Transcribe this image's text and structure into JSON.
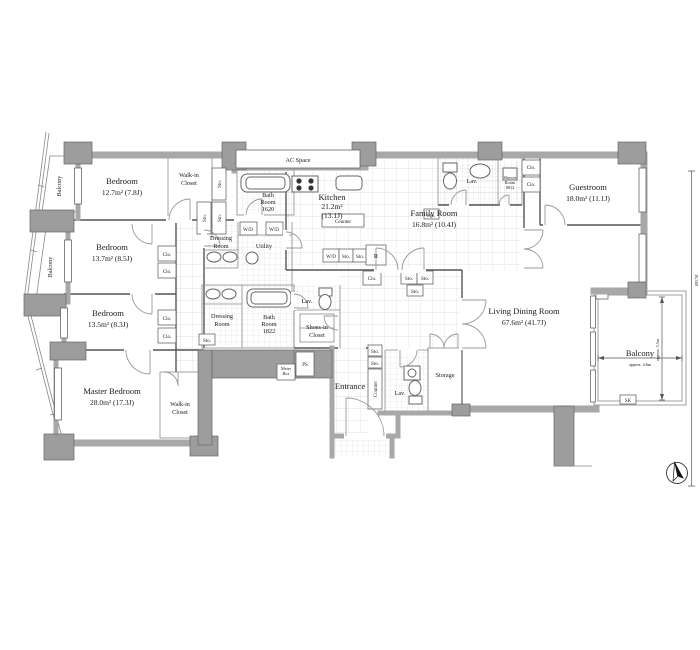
{
  "title": {
    "code": "H602",
    "suffix": "type",
    "spec": "4BR/296.90m²(89.81tsubo)"
  },
  "rooms": {
    "bedroom1": {
      "name": "Bedroom",
      "area": "12.7m²  (7.8J)"
    },
    "bedroom2": {
      "name": "Bedroom",
      "area": "13.7m²  (8.5J)"
    },
    "bedroom3": {
      "name": "Bedroom",
      "area": "13.5m²  (8.3J)"
    },
    "master": {
      "name": "Master Bedroom",
      "area": "28.0m²  (17.3J)"
    },
    "guestroom": {
      "name": "Guestroom",
      "area": "18.0m²  (11.1J)"
    },
    "kitchen": {
      "name": "Kitchen",
      "area1": "21.2m²",
      "area2": "(13.1J)"
    },
    "family": {
      "name": "Family Room",
      "area": "16.8m²  (10.4J)"
    },
    "living": {
      "name": "Living Dining Room",
      "area": "67.6m²  (41.7J)"
    },
    "bath1": {
      "l1": "Bath",
      "l2": "Room",
      "l3": "1620"
    },
    "bath2": {
      "l1": "Bath",
      "l2": "Room",
      "l3": "1822"
    },
    "shower": {
      "l1": "Shower",
      "l2": "Room",
      "l3": "0812"
    },
    "wic": {
      "l1": "Walk-in",
      "l2": "Closet"
    },
    "dressing": {
      "l1": "Dressing",
      "l2": "Room"
    },
    "shoes": {
      "l1": "Shoes-in",
      "l2": "Closet"
    },
    "utility": "Utility",
    "entrance": "Entrance",
    "storage": "Storage",
    "balcony": "Balcony",
    "ac_space": "AC Space"
  },
  "labels": {
    "sto": "Sto.",
    "clo": "Clo.",
    "wd": "W/D",
    "r": "R",
    "ps": "PS",
    "lav": "Lav.",
    "counter": "Counter",
    "sk": "SK",
    "meter1": "Meter",
    "meter2": "Box"
  },
  "dims": {
    "balcony_w": "approx. 4.6m",
    "balcony_d": "approx. 5.5m",
    "overall": "16,340"
  }
}
